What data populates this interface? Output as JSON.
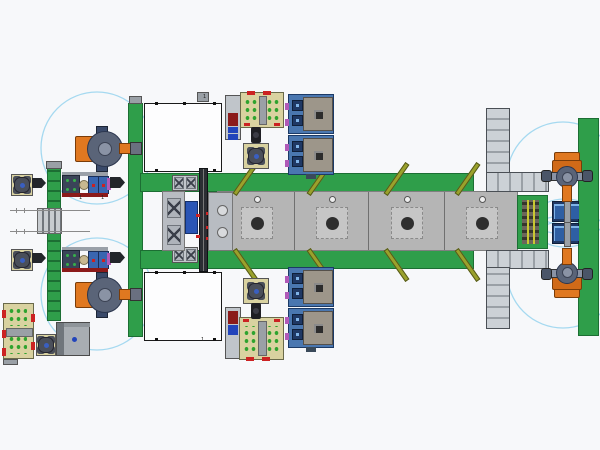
{
  "scene": {
    "type": "cad-assembly-line-plan-view",
    "description": "Top view CAD layout of an automated assembly line",
    "equipment": [
      {
        "name": "white-machine-enclosure",
        "count": 2
      },
      {
        "name": "articulated-robot",
        "count": 4
      },
      {
        "name": "green-belt-conveyor",
        "count": 5
      },
      {
        "name": "roller-conveyor-segment",
        "count": 4
      },
      {
        "name": "transfer-bed-station",
        "count": 4
      },
      {
        "name": "blue-process-machine",
        "count": 4
      },
      {
        "name": "kitting-tray",
        "count": 3
      },
      {
        "name": "rotary-fixture",
        "count": 5
      },
      {
        "name": "robot-reach-circle",
        "count": 4
      },
      {
        "name": "deflector-bar",
        "count": 8
      }
    ]
  },
  "labels": {
    "balloon": "1"
  },
  "colors": {
    "background": "#f7f8fa",
    "green": "#2f9e4a",
    "green_dark": "#1c6e33",
    "bed": "#b5b5b5",
    "bed_border": "#7f7f7f",
    "plate": "#c6c6c6",
    "hole": "#2e2e2e",
    "seg": "#ccd1d6",
    "seg_div": "#9aa0a6",
    "seg_border": "#4a4f55",
    "olive": "#9aa12b",
    "olive_dark": "#55591a",
    "orange": "#e07820",
    "navy": "#3a4a6a",
    "robot_gray": "#8a93a5",
    "machine_blue": "#4a77b0",
    "machine_border": "#1c3a66",
    "panel_tan": "#9d968a",
    "tray": "#d9d2a0",
    "tray_border": "#6a6a4a",
    "dot_green": "#2fa32f",
    "red": "#cc2222",
    "cab_red": "#8b1a1a",
    "cab_blue": "#2244bb",
    "carriage": "#2a55b5",
    "fixture_navy": "#1f3864",
    "fixture_blue": "#2e5fa3",
    "arc": "#a5d9f0",
    "white": "#fdfdfe",
    "rail": "#2b2e33",
    "magenta": "#b05ab8",
    "yellow": "#c8c832",
    "gray_metal": "#9aa0a6",
    "gray_light": "#c0c5ca",
    "steel": "#b8bcc2"
  }
}
